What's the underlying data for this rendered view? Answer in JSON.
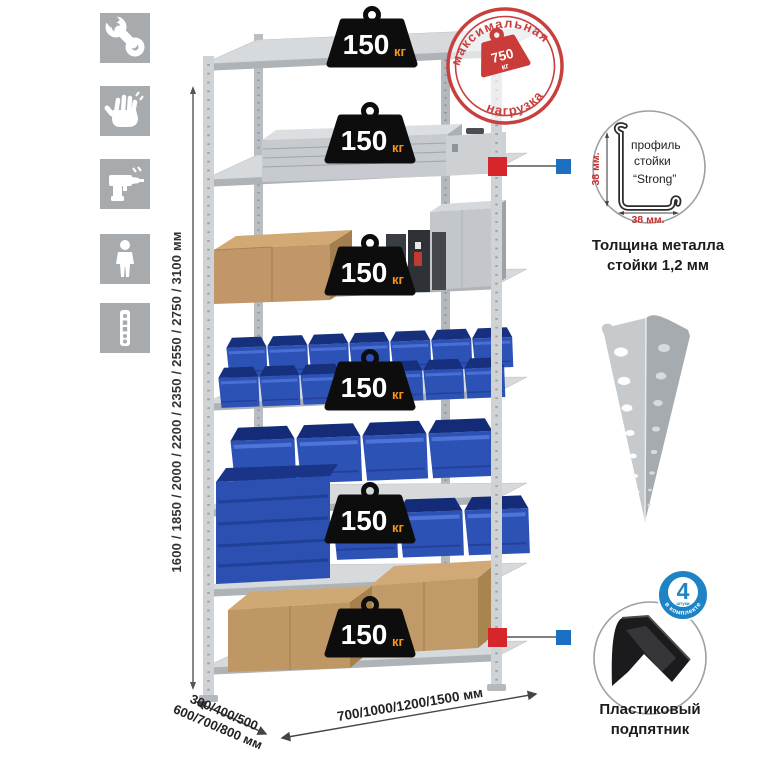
{
  "colors": {
    "stamp_red": "#c8403e",
    "weight_black": "#0d0d0d",
    "unit_orange": "#f7941d",
    "bin_blue": "#2d52b6",
    "badge_blue": "#1d83c4",
    "marker_red": "#d6262c",
    "marker_blue": "#1b6fc0",
    "metal_gray": "#c9cdd1",
    "cardboard_tan": "#c1976a"
  },
  "sidebar": {
    "icons": [
      "tools",
      "gloves",
      "drill",
      "person",
      "rack-post"
    ]
  },
  "dimensions": {
    "height": "1600 / 1850 / 2000 / 2200 / 2350 / 2550 / 2750 / 3100 мм",
    "depth_line1": "300/400/500",
    "depth_line2": "600/700/800 мм",
    "width": "700/1000/1200/1500 мм"
  },
  "rack": {
    "shelf_weights": [
      {
        "value": "150",
        "unit": "кг"
      },
      {
        "value": "150",
        "unit": "кг"
      },
      {
        "value": "150",
        "unit": "кг"
      },
      {
        "value": "150",
        "unit": "кг"
      },
      {
        "value": "150",
        "unit": "кг"
      },
      {
        "value": "150",
        "unit": "кг"
      }
    ]
  },
  "stamp": {
    "arc_top": "максимальная",
    "arc_bottom": "нагрузка",
    "value": "750",
    "unit": "кг"
  },
  "profile_detail": {
    "label_line1": "профиль",
    "label_line2": "стойки",
    "label_line3": "“Strong”",
    "dim_vertical": "38 мм.",
    "dim_horizontal": "38 мм.",
    "caption_line1": "Толщина металла",
    "caption_line2": "стойки 1,2 мм"
  },
  "foot_detail": {
    "badge_value": "4",
    "badge_unit": "штуки",
    "badge_arc": "в комплекте",
    "caption_line1": "Пластиковый",
    "caption_line2": "подпятник"
  }
}
